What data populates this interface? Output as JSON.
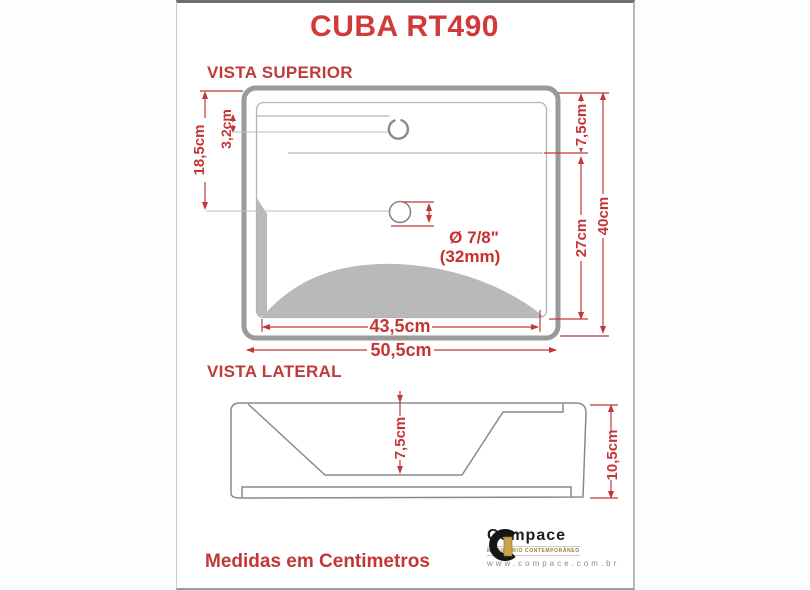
{
  "page": {
    "title": "CUBA RT490",
    "footer": "Medidas em Centimetros"
  },
  "top_view": {
    "label": "VISTA SUPERIOR",
    "dims": {
      "left_height": "18,5cm",
      "faucet_offset": "3,2cm",
      "top_to_basin": "7,5cm",
      "basin_span": "27cm",
      "total_depth": "40cm",
      "inner_width": "43,5cm",
      "outer_width": "50,5cm"
    },
    "drain": {
      "diameter_inch": "Ø 7/8\"",
      "diameter_mm": "(32mm)"
    }
  },
  "side_view": {
    "label": "VISTA LATERAL",
    "dims": {
      "basin_depth": "7,5cm",
      "total_height": "10,5cm"
    }
  },
  "logo": {
    "name": "Compace",
    "tagline": "MOBILIÁRIO CONTEMPORÂNEO",
    "url": "www.compace.com.br"
  },
  "colors": {
    "dimension_red": "#c43636",
    "title_red": "#d23a3a",
    "drawing_gray": "#9a9a9a",
    "shading_gray": "#b9b9b9",
    "logo_gold": "#c9a44f"
  }
}
